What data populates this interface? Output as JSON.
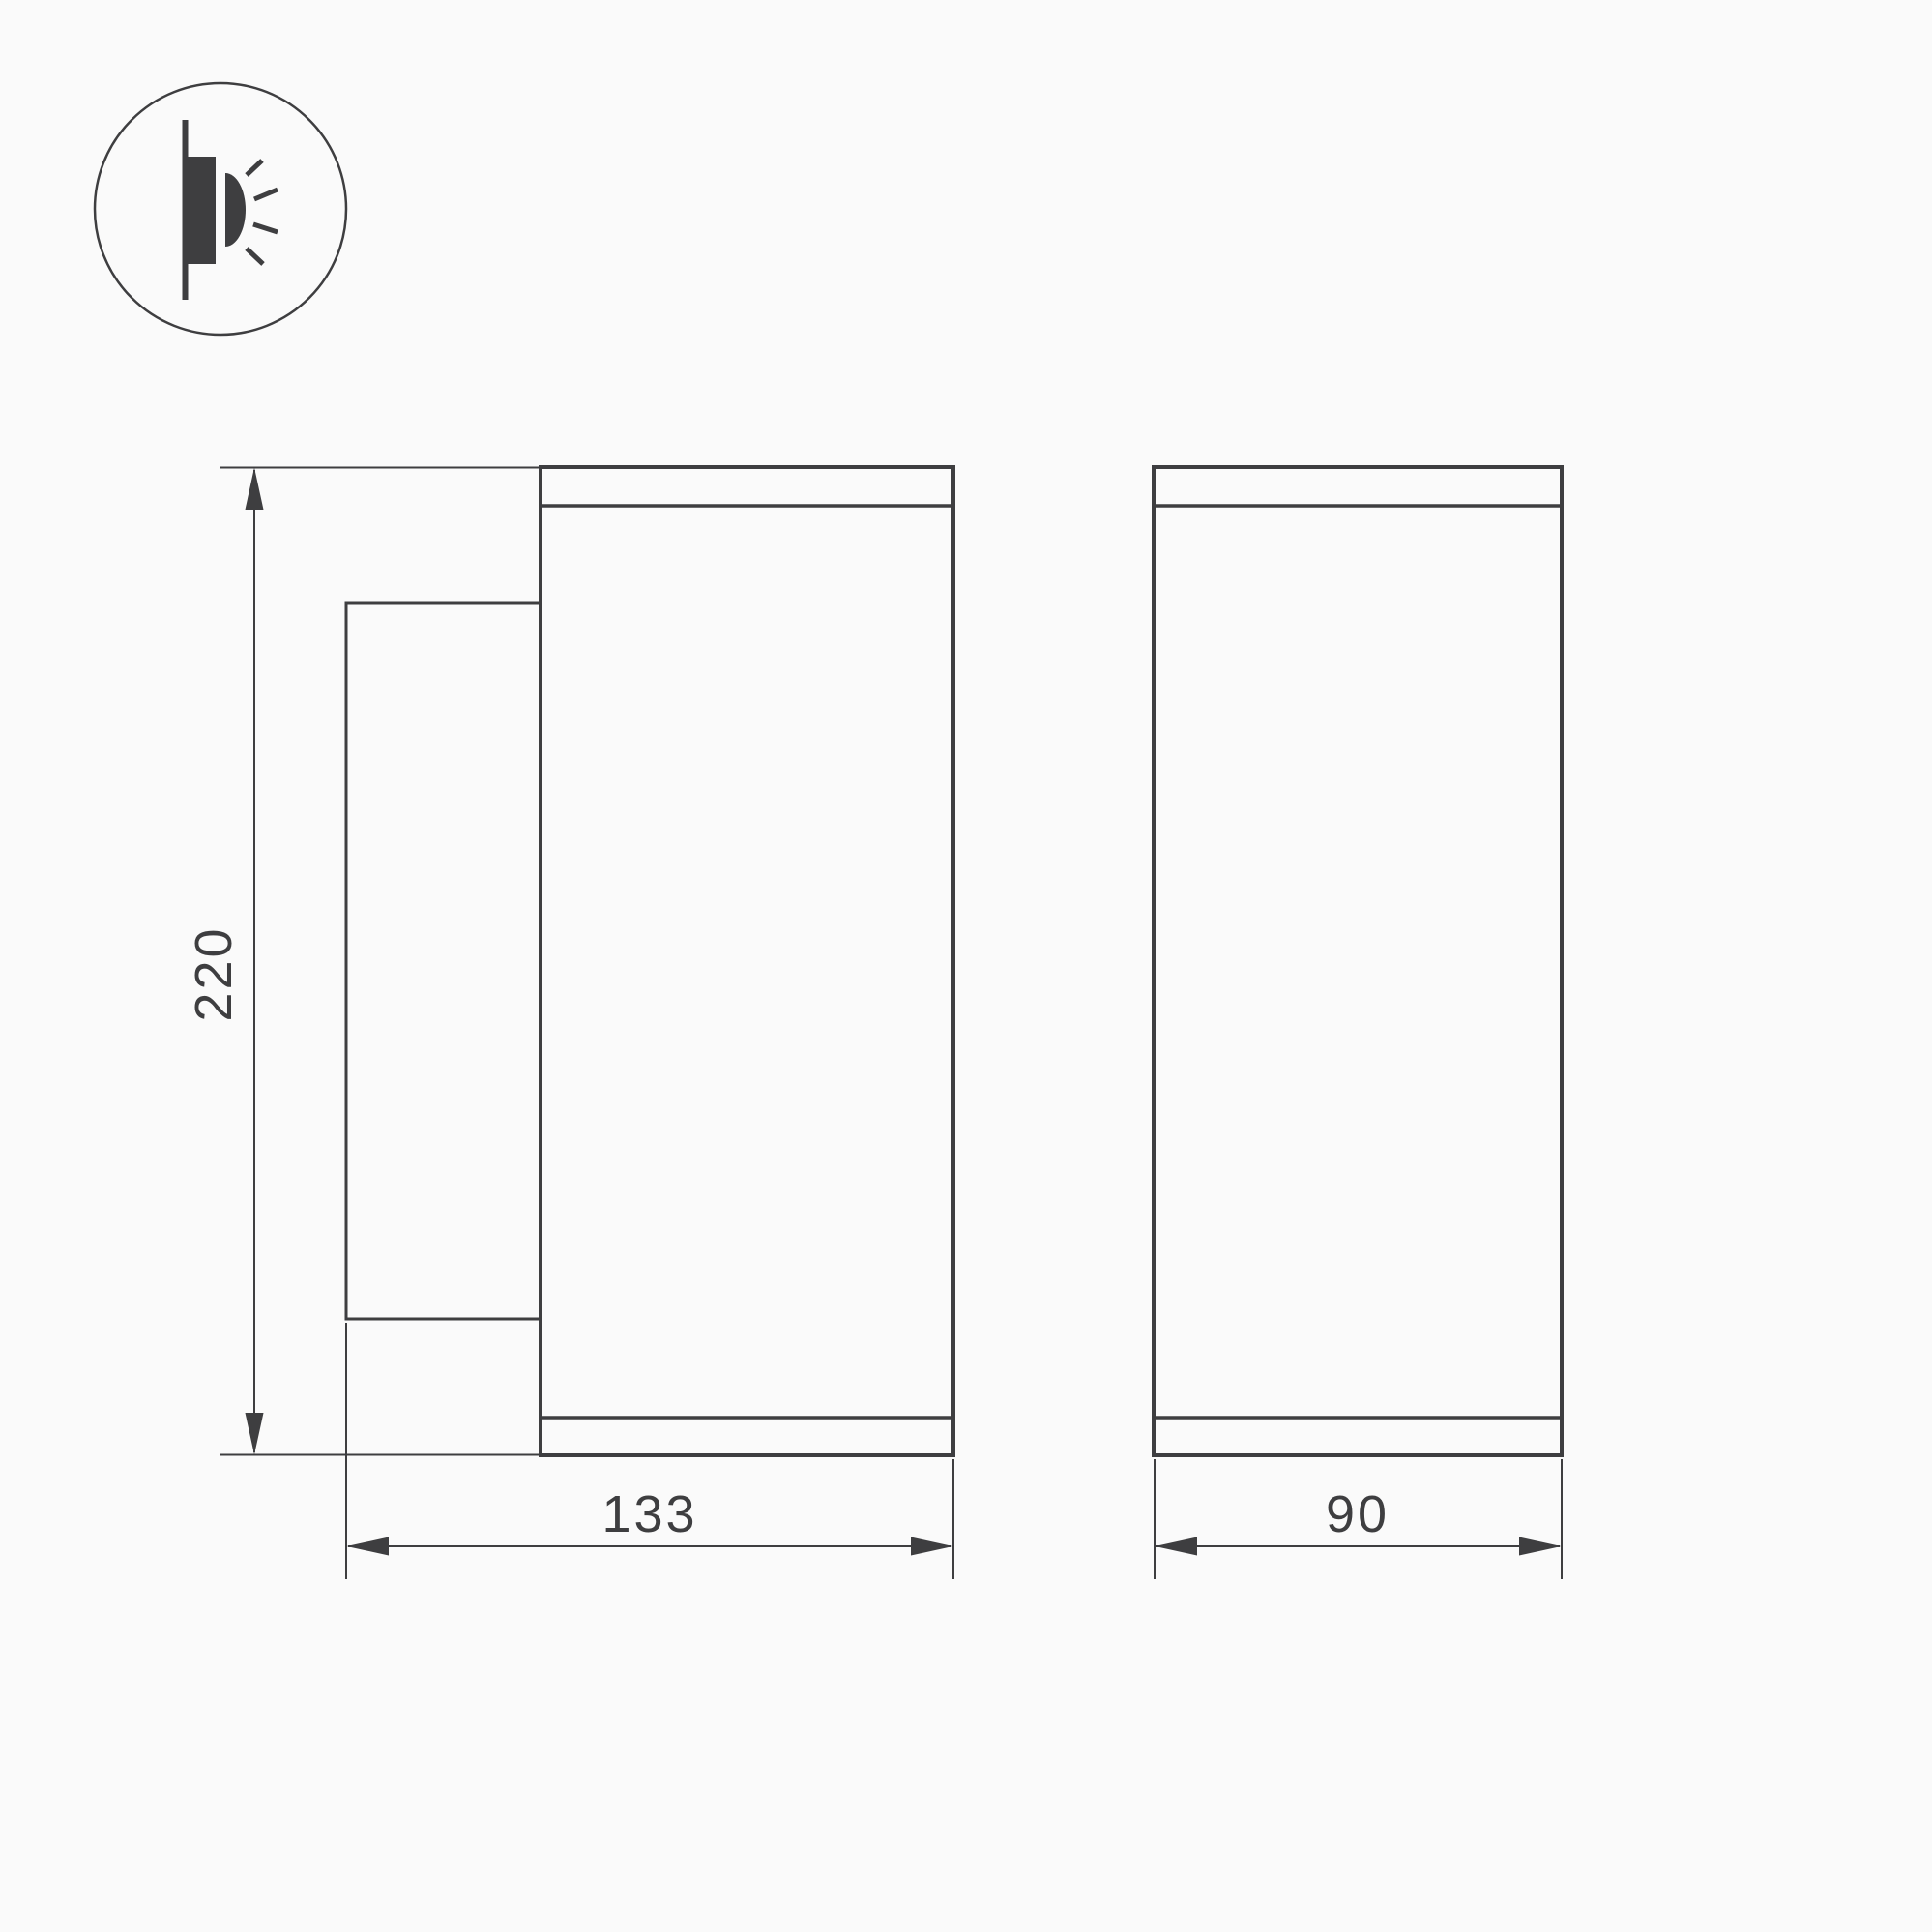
{
  "colors": {
    "background": "#fafafa",
    "line": "#3e3e40"
  },
  "icon": {
    "name": "wall-lamp-light-emission-icon"
  },
  "dimensions": {
    "height": "220",
    "depth": "133",
    "width": "90"
  }
}
